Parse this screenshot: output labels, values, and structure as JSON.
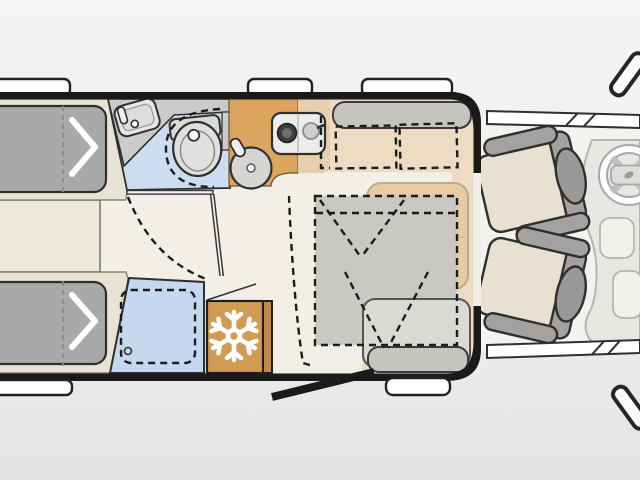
{
  "diagram": {
    "type": "motorhome-floorplan",
    "orientation": "side-view-top-down, cab at right",
    "rooms": [
      {
        "name": "twin-single-beds",
        "position": "rear-left",
        "features": [
          "two gray mattresses",
          "white chevron fold arrows",
          "dashed center lines",
          "cabinet between beds"
        ]
      },
      {
        "name": "washroom",
        "position": "mid-top",
        "features": [
          "corner washbasin with faucet",
          "swivel toilet with dashed rotation arc",
          "blue floor",
          "open door shown solid with dashed swing arc"
        ]
      },
      {
        "name": "shower",
        "position": "mid-bottom",
        "features": [
          "blue tray",
          "dashed inner outline",
          "drain circle"
        ]
      },
      {
        "name": "kitchen",
        "position": "mid-top",
        "features": [
          "L-shaped orange counter",
          "round sink with faucet",
          "two-burner cooktop unit",
          "light sideboard"
        ]
      },
      {
        "name": "refrigerator",
        "position": "mid-bottom",
        "features": [
          "snowflake symbol",
          "open-flap line"
        ]
      },
      {
        "name": "dinette",
        "position": "center-right",
        "features": [
          "facing bench seats with gray backrests",
          "dashed seat cushions",
          "tan table",
          "gray dashed bed-conversion overlay with fold marks"
        ]
      },
      {
        "name": "entry",
        "position": "bottom",
        "features": [
          "open door drawn as black bar",
          "entry step",
          "dashed swing line"
        ]
      },
      {
        "name": "cab",
        "position": "front-right",
        "features": [
          "two swivelled captain seats",
          "steering wheel",
          "dashboard",
          "side window bands",
          "two exterior mirrors"
        ]
      }
    ],
    "windows": {
      "top_count": 3,
      "bottom_count": 1,
      "cab_band_slashes": 2
    },
    "icons": [
      "snowflake-icon",
      "steering-wheel-icon",
      "chevron-arrow-icon",
      "faucet-icon"
    ]
  },
  "palette": {
    "bg1": "#f5f5f4",
    "bg2": "#e4e4e3",
    "floor": "#f2efe7",
    "platform": "#e9e3d6",
    "mattress": "#a9a9a9",
    "bathfloor": "#cdddf1",
    "counter": "#cbcbca",
    "fixture": "#e0e0df",
    "kitchen": "#dba45f",
    "kitchenlight": "#e6d0ac",
    "fridge": "#d09c55",
    "fridgeband": "#bd8a49",
    "shower": "#c6d8ef",
    "benchbase": "#eddcc1",
    "backrest": "#c6c4bf",
    "cushion": "#c9c7c2",
    "table": "#e9cba2",
    "overlay": "#cac8c3",
    "seatbtm": "#dbd9d4",
    "cabfloor": "#f4f2ee",
    "dashpanel": "#e8e7e3",
    "dashline": "#b5b5b5",
    "seatcushion": "#e8e0d1",
    "seatgray": "#a3a2a0",
    "headrest": "#9a9998",
    "wall": "#1a1a1a",
    "line": "#2f2f2f",
    "white": "#ffffff"
  }
}
